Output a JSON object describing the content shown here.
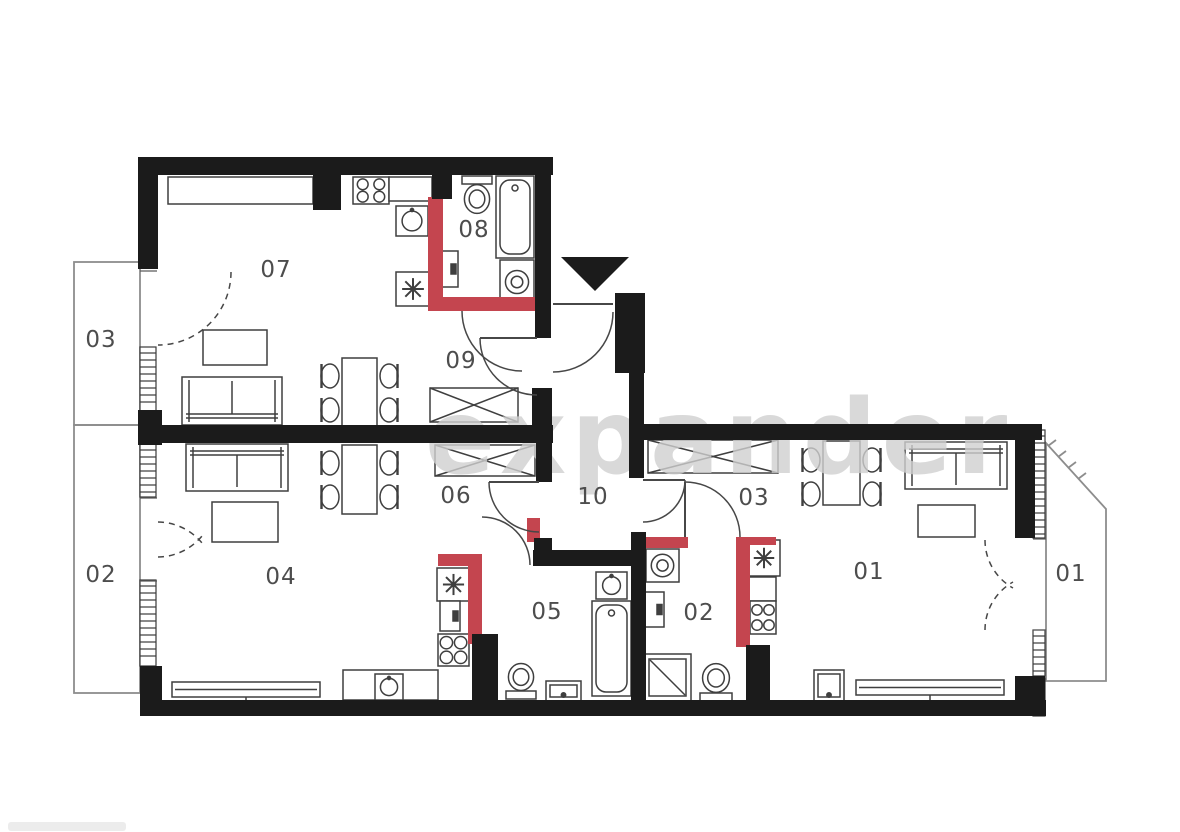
{
  "canvas": {
    "w": 1180,
    "h": 832
  },
  "watermark": {
    "text": "expander",
    "color": "#cfcfcf",
    "x": 425,
    "y": 473,
    "size": 103
  },
  "colors": {
    "wall": "#1b1b1b",
    "plumbing_wall": "#c4454f",
    "furniture_line": "#3f3f3f",
    "door_line": "#474747",
    "balcony_line": "#8d8d8d",
    "label": "#4d4d4d",
    "background": "#ffffff"
  },
  "entrance_arrow": {
    "points": [
      [
        561,
        257
      ],
      [
        629,
        257
      ],
      [
        595,
        291
      ]
    ]
  },
  "room_labels": [
    {
      "id": "07",
      "label": "07",
      "x": 276,
      "y": 269,
      "kind": "room"
    },
    {
      "id": "08",
      "label": "08",
      "x": 474,
      "y": 229,
      "kind": "room"
    },
    {
      "id": "09",
      "label": "09",
      "x": 461,
      "y": 360,
      "kind": "room"
    },
    {
      "id": "06",
      "label": "06",
      "x": 456,
      "y": 495,
      "kind": "room"
    },
    {
      "id": "10",
      "label": "10",
      "x": 593,
      "y": 496,
      "kind": "room"
    },
    {
      "id": "05",
      "label": "05",
      "x": 547,
      "y": 611,
      "kind": "room"
    },
    {
      "id": "04",
      "label": "04",
      "x": 281,
      "y": 576,
      "kind": "room"
    },
    {
      "id": "03",
      "label": "03",
      "x": 754,
      "y": 497,
      "kind": "room"
    },
    {
      "id": "02",
      "label": "02",
      "x": 699,
      "y": 612,
      "kind": "room"
    },
    {
      "id": "01",
      "label": "01",
      "x": 869,
      "y": 571,
      "kind": "room"
    },
    {
      "id": "balcony-03",
      "label": "03",
      "x": 101,
      "y": 339,
      "kind": "balcony"
    },
    {
      "id": "balcony-02",
      "label": "02",
      "x": 101,
      "y": 574,
      "kind": "balcony"
    },
    {
      "id": "balcony-01",
      "label": "01",
      "x": 1071,
      "y": 573,
      "kind": "balcony"
    }
  ],
  "walls": [
    [
      140,
      157,
      413,
      18
    ],
    [
      138,
      157,
      20,
      112
    ],
    [
      138,
      410,
      24,
      35
    ],
    [
      140,
      666,
      22,
      50
    ],
    [
      140,
      700,
      906,
      16
    ],
    [
      156,
      425,
      397,
      18
    ],
    [
      535,
      157,
      16,
      181
    ],
    [
      532,
      388,
      20,
      55
    ],
    [
      536,
      443,
      16,
      39
    ],
    [
      534,
      538,
      18,
      14
    ],
    [
      533,
      550,
      98,
      16
    ],
    [
      615,
      293,
      30,
      80
    ],
    [
      629,
      373,
      15,
      105
    ],
    [
      629,
      424,
      413,
      16
    ],
    [
      1015,
      424,
      20,
      114
    ],
    [
      1015,
      676,
      30,
      40
    ],
    [
      631,
      532,
      15,
      170
    ],
    [
      472,
      634,
      26,
      70
    ],
    [
      746,
      645,
      24,
      57
    ],
    [
      313,
      175,
      28,
      35
    ],
    [
      432,
      175,
      20,
      24
    ]
  ],
  "plumbing_walls": [
    [
      428,
      197,
      15,
      114
    ],
    [
      428,
      297,
      107,
      14
    ],
    [
      438,
      554,
      44,
      12
    ],
    [
      468,
      554,
      14,
      90
    ],
    [
      527,
      518,
      13,
      24
    ],
    [
      643,
      537,
      45,
      11
    ],
    [
      736,
      537,
      14,
      110
    ],
    [
      748,
      537,
      28,
      8
    ]
  ],
  "windows": [
    [
      140,
      347,
      16,
      65
    ],
    [
      140,
      444,
      16,
      53
    ],
    [
      140,
      580,
      16,
      86
    ],
    [
      1033,
      430,
      12,
      108
    ],
    [
      1033,
      630,
      12,
      46
    ],
    [
      1033,
      678,
      12,
      38
    ]
  ],
  "thin_lines": [
    [
      140,
      271,
      157,
      271
    ],
    [
      140,
      498,
      157,
      498
    ],
    [
      140,
      581,
      157,
      581
    ],
    [
      1033,
      539,
      1046,
      539
    ],
    [
      1033,
      630,
      1046,
      630
    ]
  ],
  "balconies": {
    "rects": [
      [
        74,
        262,
        66,
        163
      ],
      [
        74,
        425,
        66,
        268
      ]
    ],
    "polygon": [
      [
        1046,
        443
      ],
      [
        1106,
        509
      ],
      [
        1106,
        681
      ],
      [
        1046,
        681
      ]
    ],
    "railing_ticks": [
      [
        1048,
        446,
        1056,
        440
      ],
      [
        1058,
        457,
        1066,
        451
      ],
      [
        1068,
        468,
        1076,
        462
      ],
      [
        1078,
        479,
        1086,
        473
      ]
    ]
  },
  "doors": [
    {
      "name": "entrance-door",
      "x1": 613,
      "y1": 312,
      "x2": 553,
      "y2": 372,
      "r": 60,
      "sweep": 1,
      "dashed": false,
      "leaf": [
        553,
        304,
        613,
        304
      ]
    },
    {
      "name": "door-09",
      "x1": 480,
      "y1": 338,
      "x2": 537,
      "y2": 395,
      "r": 57,
      "sweep": 0,
      "dashed": false,
      "leaf": [
        537,
        338,
        480,
        338
      ]
    },
    {
      "name": "door-08",
      "x1": 462,
      "y1": 311,
      "x2": 522,
      "y2": 371,
      "r": 60,
      "sweep": 0,
      "dashed": false
    },
    {
      "name": "door-06",
      "x1": 489,
      "y1": 482,
      "x2": 539,
      "y2": 532,
      "r": 50,
      "sweep": 0,
      "dashed": false,
      "leaf": [
        539,
        482,
        489,
        482
      ]
    },
    {
      "name": "door-05",
      "x1": 482,
      "y1": 517,
      "x2": 530,
      "y2": 565,
      "r": 48,
      "sweep": 1,
      "dashed": false
    },
    {
      "name": "door-10-03",
      "x1": 685,
      "y1": 480,
      "x2": 643,
      "y2": 522,
      "r": 42,
      "sweep": 1,
      "dashed": false,
      "leaf": [
        643,
        480,
        685,
        480
      ]
    },
    {
      "name": "door-02",
      "x1": 685,
      "y1": 482,
      "x2": 740,
      "y2": 537,
      "r": 55,
      "sweep": 1,
      "dashed": false,
      "leaf": [
        685,
        537,
        685,
        482
      ]
    },
    {
      "name": "balcony-door-03",
      "x1": 231,
      "y1": 272,
      "x2": 158,
      "y2": 345,
      "r": 73,
      "sweep": 1,
      "dashed": true
    },
    {
      "name": "balcony-door-02a",
      "x1": 158,
      "y1": 557,
      "x2": 202,
      "y2": 536,
      "r": 58,
      "sweep": 0,
      "dashed": true
    },
    {
      "name": "balcony-door-02b",
      "x1": 158,
      "y1": 522,
      "x2": 202,
      "y2": 543,
      "r": 58,
      "sweep": 1,
      "dashed": true
    },
    {
      "name": "balcony-door-01a",
      "x1": 985,
      "y1": 540,
      "x2": 1013,
      "y2": 588,
      "r": 55,
      "sweep": 0,
      "dashed": true
    },
    {
      "name": "balcony-door-01b",
      "x1": 985,
      "y1": 630,
      "x2": 1013,
      "y2": 582,
      "r": 55,
      "sweep": 1,
      "dashed": true
    }
  ],
  "furniture": [
    {
      "t": "counter",
      "name": "kitchen-counter",
      "r": [
        168,
        177,
        145,
        27
      ]
    },
    {
      "t": "stove",
      "name": "stove-burners",
      "r": [
        353,
        177,
        36,
        27
      ]
    },
    {
      "t": "counter",
      "name": "kitchen-counter",
      "r": [
        389,
        177,
        43,
        24
      ]
    },
    {
      "t": "sink",
      "name": "kitchen-sink",
      "r": [
        396,
        206,
        32,
        30
      ]
    },
    {
      "t": "star",
      "name": "boiler",
      "r": [
        396,
        272,
        34,
        34
      ]
    },
    {
      "t": "unit",
      "name": "appliance",
      "r": [
        436,
        251,
        22,
        36
      ]
    },
    {
      "t": "table",
      "name": "coffee-table",
      "r": [
        203,
        330,
        64,
        35
      ]
    },
    {
      "t": "sofa",
      "name": "sofa",
      "r": [
        182,
        377,
        100,
        48
      ],
      "back": "b"
    },
    {
      "t": "table",
      "name": "dining-table",
      "r": [
        342,
        358,
        35,
        69
      ]
    },
    {
      "t": "chair",
      "name": "chair",
      "r": [
        320,
        362,
        20,
        28
      ],
      "side": "l"
    },
    {
      "t": "chair",
      "name": "chair",
      "r": [
        320,
        396,
        20,
        28
      ],
      "side": "l"
    },
    {
      "t": "chair",
      "name": "chair",
      "r": [
        379,
        362,
        20,
        28
      ],
      "side": "r"
    },
    {
      "t": "chair",
      "name": "chair",
      "r": [
        379,
        396,
        20,
        28
      ],
      "side": "r"
    },
    {
      "t": "toilet",
      "name": "toilet",
      "r": [
        462,
        176,
        30,
        38
      ],
      "tank": "t"
    },
    {
      "t": "tub",
      "name": "bathtub",
      "r": [
        496,
        176,
        38,
        82
      ]
    },
    {
      "t": "washer",
      "name": "washing-machine",
      "r": [
        500,
        260,
        34,
        44
      ]
    },
    {
      "t": "wardrobe",
      "name": "wardrobe",
      "r": [
        430,
        388,
        88,
        34
      ]
    },
    {
      "t": "wardrobe",
      "name": "wardrobe",
      "r": [
        435,
        445,
        100,
        31
      ]
    },
    {
      "t": "sofa",
      "name": "sofa",
      "r": [
        186,
        444,
        102,
        47
      ],
      "back": "t"
    },
    {
      "t": "table",
      "name": "coffee-table",
      "r": [
        212,
        502,
        66,
        40
      ]
    },
    {
      "t": "table",
      "name": "dining-table",
      "r": [
        342,
        445,
        35,
        69
      ]
    },
    {
      "t": "chair",
      "name": "chair",
      "r": [
        320,
        449,
        20,
        28
      ],
      "side": "l"
    },
    {
      "t": "chair",
      "name": "chair",
      "r": [
        320,
        483,
        20,
        28
      ],
      "side": "l"
    },
    {
      "t": "chair",
      "name": "chair",
      "r": [
        379,
        449,
        20,
        28
      ],
      "side": "r"
    },
    {
      "t": "chair",
      "name": "chair",
      "r": [
        379,
        483,
        20,
        28
      ],
      "side": "r"
    },
    {
      "t": "radiator",
      "name": "radiator",
      "r": [
        172,
        682,
        148,
        15
      ]
    },
    {
      "t": "star",
      "name": "boiler",
      "r": [
        437,
        568,
        33,
        33
      ]
    },
    {
      "t": "unit",
      "name": "appliance",
      "r": [
        440,
        601,
        20,
        30
      ]
    },
    {
      "t": "stove",
      "name": "stove-burners",
      "r": [
        438,
        634,
        31,
        32
      ]
    },
    {
      "t": "counter",
      "name": "kitchen-counter",
      "r": [
        343,
        670,
        95,
        30
      ]
    },
    {
      "t": "sink",
      "name": "kitchen-sink",
      "r": [
        375,
        674,
        28,
        26
      ]
    },
    {
      "t": "sink",
      "name": "washbasin",
      "r": [
        596,
        572,
        31,
        27
      ]
    },
    {
      "t": "tub",
      "name": "bathtub",
      "r": [
        592,
        601,
        39,
        95
      ]
    },
    {
      "t": "toilet",
      "name": "toilet",
      "r": [
        506,
        663,
        30,
        36
      ],
      "tank": "b"
    },
    {
      "t": "unit2",
      "name": "washbasin-console",
      "r": [
        546,
        681,
        35,
        20
      ]
    },
    {
      "t": "wardrobe",
      "name": "wardrobe",
      "r": [
        648,
        440,
        130,
        33
      ]
    },
    {
      "t": "table",
      "name": "dining-table",
      "r": [
        823,
        441,
        37,
        64
      ]
    },
    {
      "t": "chair",
      "name": "chair",
      "r": [
        801,
        446,
        20,
        28
      ],
      "side": "l"
    },
    {
      "t": "chair",
      "name": "chair",
      "r": [
        801,
        480,
        20,
        28
      ],
      "side": "l"
    },
    {
      "t": "chair",
      "name": "chair",
      "r": [
        862,
        446,
        20,
        28
      ],
      "side": "r"
    },
    {
      "t": "chair",
      "name": "chair",
      "r": [
        862,
        480,
        20,
        28
      ],
      "side": "r"
    },
    {
      "t": "washer",
      "name": "washing-machine",
      "r": [
        646,
        549,
        33,
        33
      ]
    },
    {
      "t": "unit",
      "name": "appliance",
      "r": [
        645,
        592,
        19,
        35
      ]
    },
    {
      "t": "shower",
      "name": "shower",
      "r": [
        644,
        654,
        47,
        47
      ]
    },
    {
      "t": "toilet",
      "name": "toilet",
      "r": [
        700,
        663,
        32,
        38
      ],
      "tank": "b"
    },
    {
      "t": "star",
      "name": "boiler",
      "r": [
        748,
        540,
        32,
        36
      ]
    },
    {
      "t": "counter",
      "name": "kitchen-counter",
      "r": [
        748,
        577,
        28,
        24
      ]
    },
    {
      "t": "stove",
      "name": "stove-burners",
      "r": [
        750,
        601,
        26,
        33
      ]
    },
    {
      "t": "sofa",
      "name": "sofa",
      "r": [
        905,
        442,
        102,
        47
      ],
      "back": "t"
    },
    {
      "t": "table",
      "name": "coffee-table",
      "r": [
        918,
        505,
        57,
        32
      ]
    },
    {
      "t": "unit2",
      "name": "washbasin-console",
      "r": [
        814,
        670,
        30,
        31
      ]
    },
    {
      "t": "radiator",
      "name": "radiator",
      "r": [
        856,
        680,
        148,
        15
      ]
    }
  ],
  "footer_artifact": {
    "x": 8,
    "y": 822,
    "w": 118,
    "h": 9,
    "color": "#ececec"
  }
}
